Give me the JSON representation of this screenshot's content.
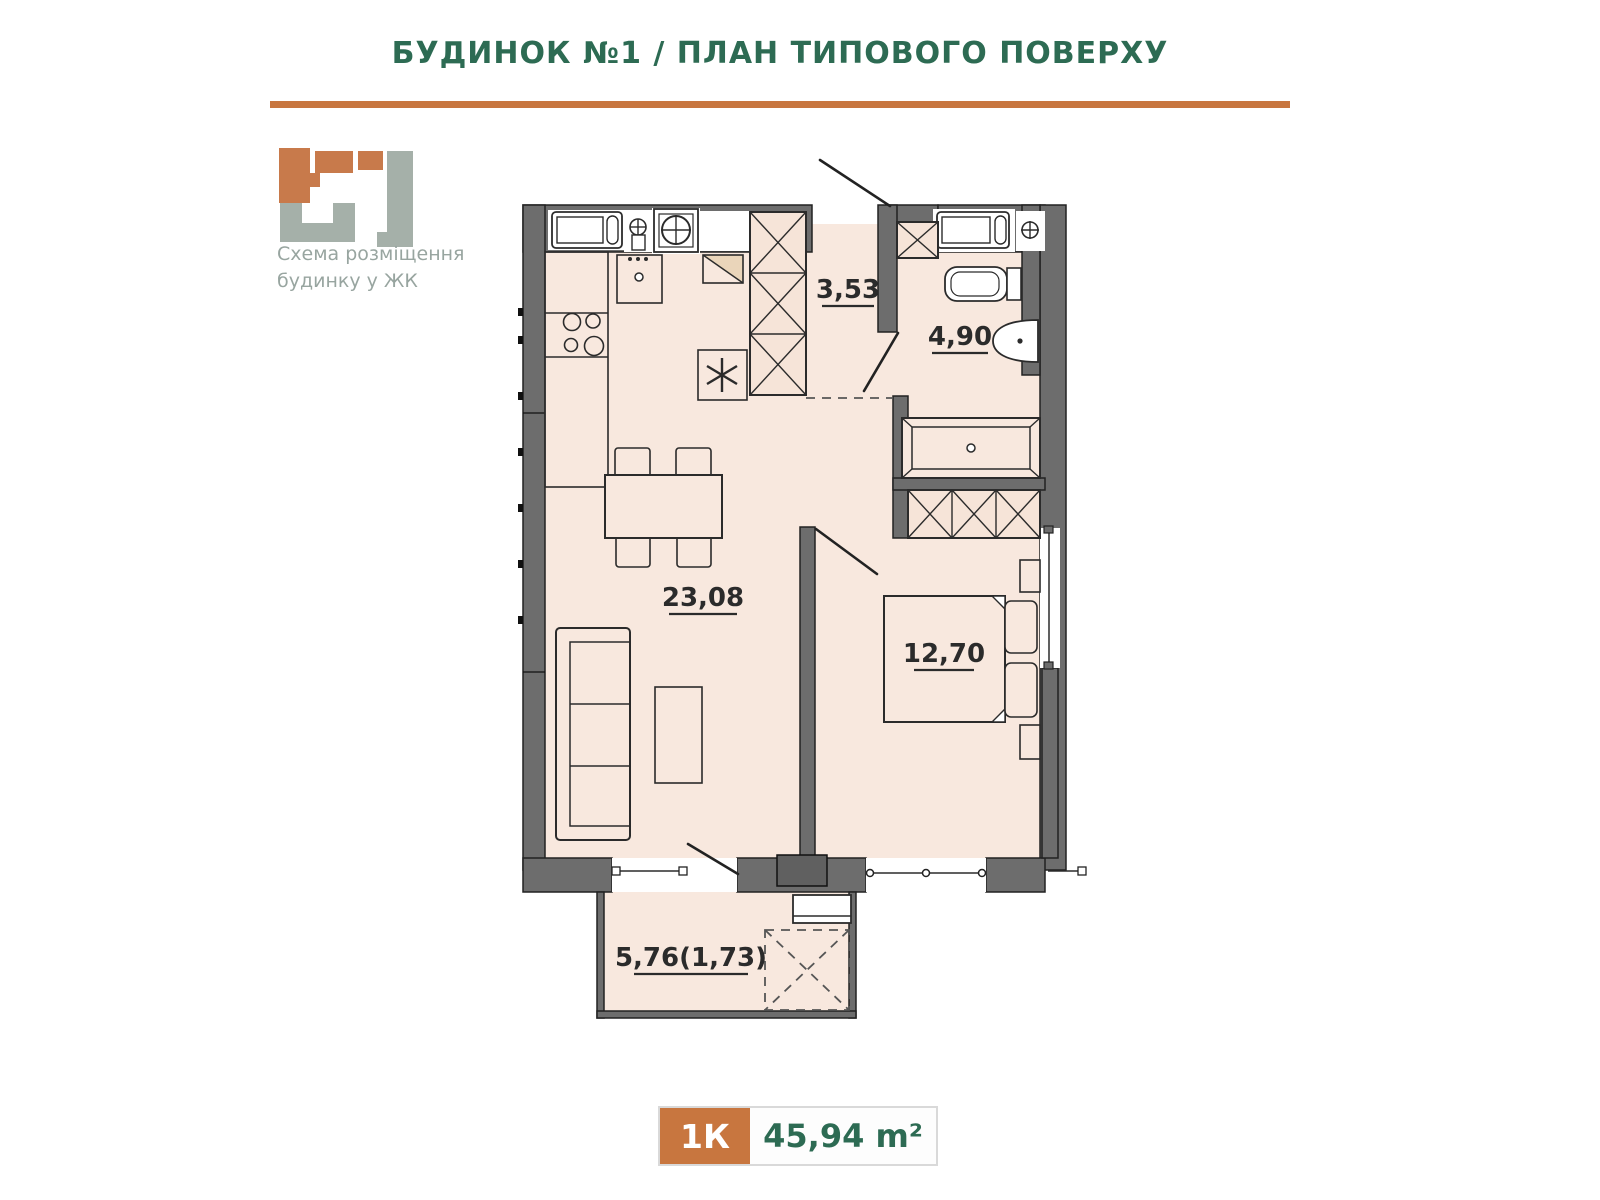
{
  "header": {
    "title": "БУДИНОК №1 / ПЛАН ТИПОВОГО ПОВЕРХУ"
  },
  "logo": {
    "caption_line1": "Схема розміщення",
    "caption_line2": "будинку у ЖК"
  },
  "plan": {
    "rooms": [
      {
        "name": "hallway",
        "area_label": "3,53"
      },
      {
        "name": "bathroom",
        "area_label": "4,90"
      },
      {
        "name": "living-kitchen",
        "area_label": "23,08"
      },
      {
        "name": "bedroom",
        "area_label": "12,70"
      },
      {
        "name": "balcony",
        "area_label": "5,76(1,73)"
      }
    ]
  },
  "badge": {
    "layout_label": "1К",
    "total_area": "45,94 m²"
  },
  "colors": {
    "accent_orange": "#c8763f",
    "title_green": "#2d6b53",
    "wall_gray": "#6d6d6d",
    "floor_peach": "#f8e8de",
    "logo_gray": "#a5b0a9",
    "logo_orange": "#c87a4b",
    "label_dark": "#2b2b2b"
  }
}
